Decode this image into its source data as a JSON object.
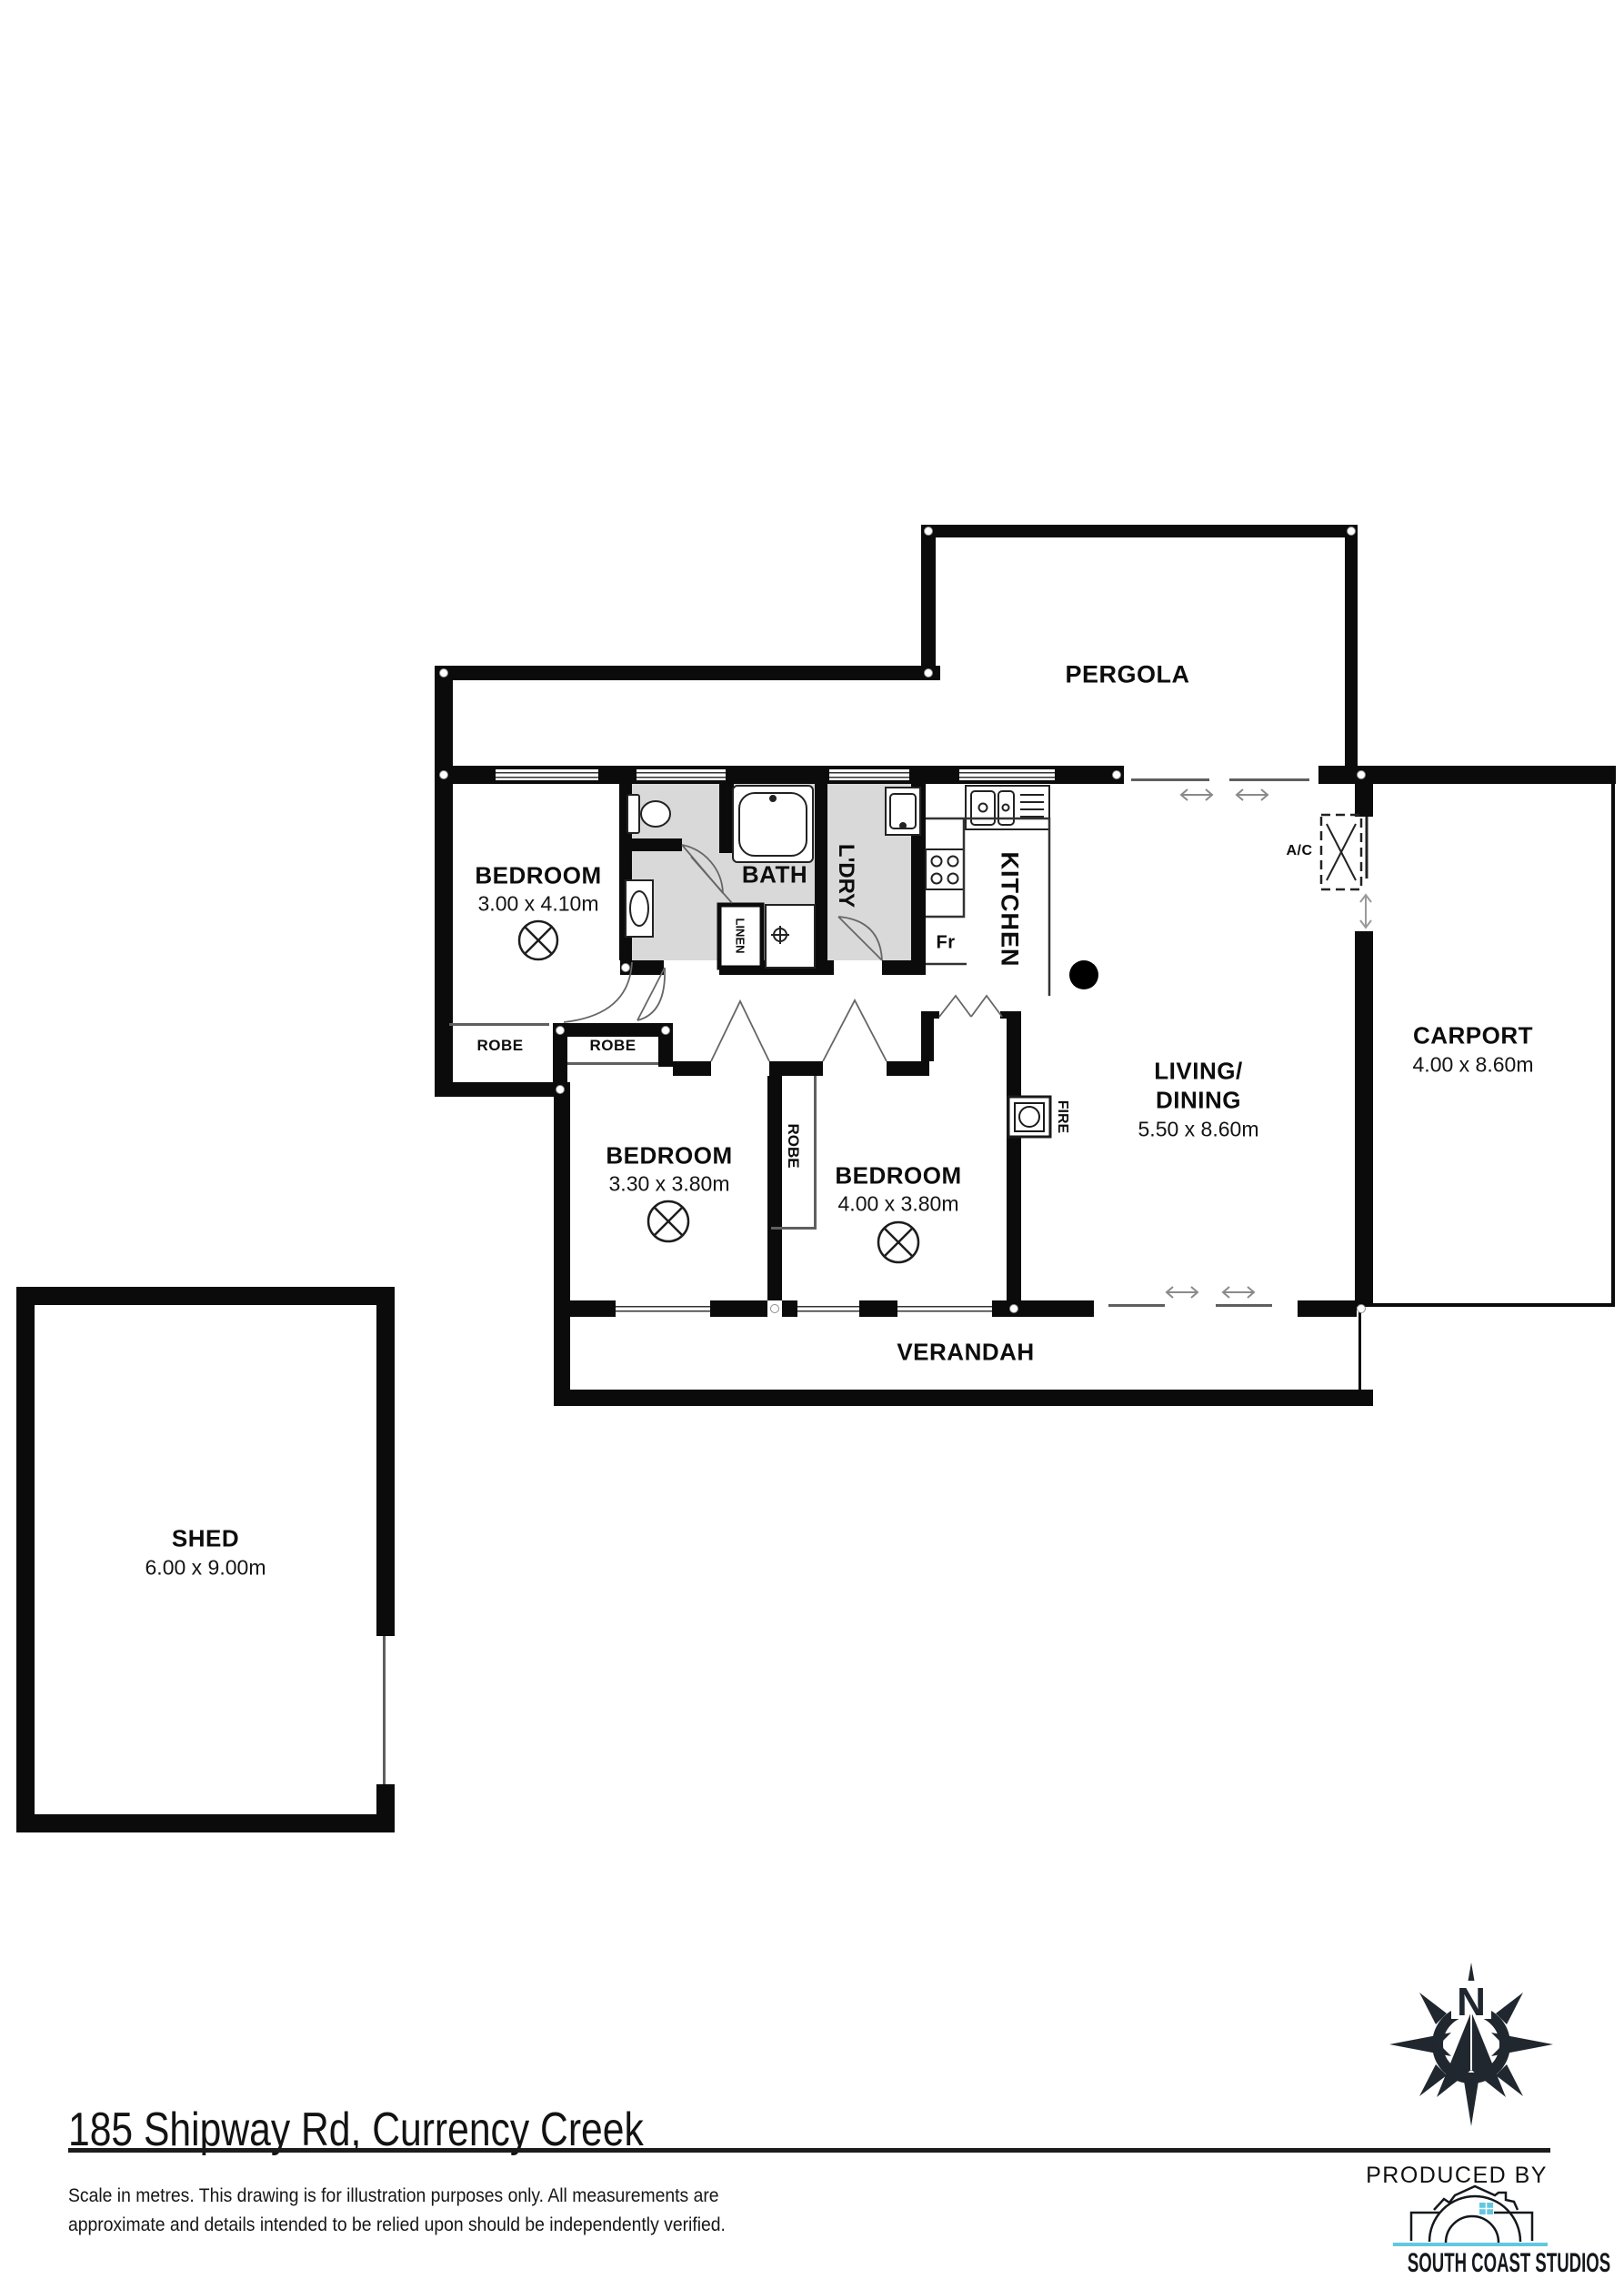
{
  "colors": {
    "wall": "#0b0b0b",
    "wet_area": "#d9d9d9",
    "brand_dark": "#20272e",
    "brand_blue": "#62c8e0"
  },
  "rooms": {
    "pergola": {
      "label": "PERGOLA"
    },
    "bedroom1": {
      "label": "BEDROOM",
      "dims": "3.00 x 4.10m"
    },
    "bedroom2": {
      "label": "BEDROOM",
      "dims": "3.30 x 3.80m"
    },
    "bedroom3": {
      "label": "BEDROOM",
      "dims": "4.00 x 3.80m"
    },
    "living": {
      "label1": "LIVING/",
      "label2": "DINING",
      "dims": "5.50 x 8.60m"
    },
    "kitchen": {
      "label": "KITCHEN"
    },
    "bath": {
      "label": "BATH"
    },
    "laundry": {
      "label": "L'DRY"
    },
    "linen": {
      "label": "LINEN"
    },
    "robe1": {
      "label": "ROBE"
    },
    "robe2": {
      "label": "ROBE"
    },
    "robe3": {
      "label": "ROBE"
    },
    "verandah": {
      "label": "VERANDAH"
    },
    "carport": {
      "label": "CARPORT",
      "dims": "4.00 x 8.60m"
    },
    "shed": {
      "label": "SHED",
      "dims": "6.00 x 9.00m"
    }
  },
  "fixtures": {
    "fridge": "Fr",
    "fire": "FIRE",
    "ac": "A/C"
  },
  "compass": {
    "north_label": "N"
  },
  "footer": {
    "address": "185 Shipway Rd, Currency Creek",
    "disclaimer_line1": "Scale in metres. This drawing is for illustration purposes only. All measurements are",
    "disclaimer_line2": "approximate and details intended to be relied upon should be independently verified.",
    "produced_by": "PRODUCED BY",
    "studio": "SOUTH COAST STUDIOS"
  }
}
